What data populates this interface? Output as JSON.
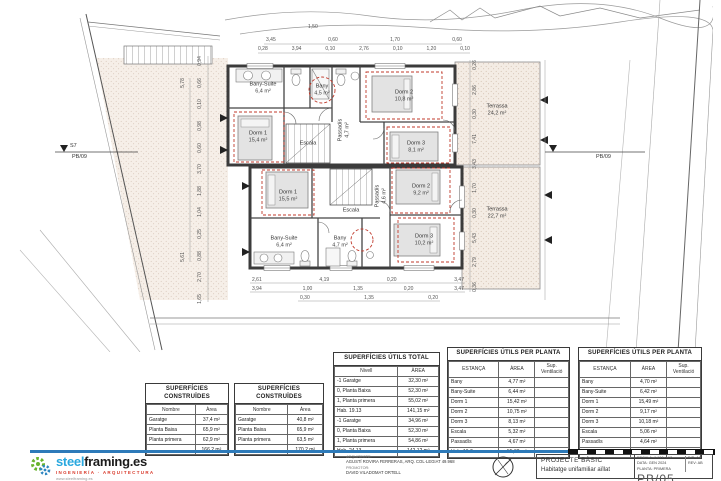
{
  "plan": {
    "upper": {
      "bany_suite": {
        "name": "Bany-Suite",
        "area": "6,4 m²"
      },
      "bany": {
        "name": "Bany",
        "area": "4,5 m²"
      },
      "dorm1": {
        "name": "Dorm 1",
        "area": "15,4 m²"
      },
      "dorm2": {
        "name": "Dorm 2",
        "area": "10,8 m²"
      },
      "dorm3": {
        "name": "Dorm 3",
        "area": "8,1 m²"
      },
      "escala": {
        "name": "Escala",
        "area": "5,3 m²"
      },
      "passadis": {
        "name": "Passadís",
        "area": "4,7 m²"
      },
      "terrassa": {
        "name": "Terrassa",
        "area": "24,2 m²"
      }
    },
    "lower": {
      "dorm1": {
        "name": "Dorm 1",
        "area": "15,5 m²"
      },
      "dorm2": {
        "name": "Dorm 2",
        "area": "9,2 m²"
      },
      "dorm3": {
        "name": "Dorm 3",
        "area": "10,2 m²"
      },
      "bany_suite": {
        "name": "Bany-Suite",
        "area": "6,4 m²"
      },
      "bany": {
        "name": "Bany",
        "area": "4,7 m²"
      },
      "escala": {
        "name": "Escala",
        "area": "5,1 m²"
      },
      "passadis": {
        "name": "Passadís",
        "area": "4,6 m²"
      },
      "terrassa": {
        "name": "Terrassa",
        "area": "22,7 m²"
      }
    },
    "markers": {
      "left_code": "S7",
      "left_sheet": "PB/09",
      "right_sheet": "PB/09"
    },
    "dims": {
      "top0": "1,50",
      "top1": [
        "3,45",
        "0,60",
        "1,70",
        "0,60"
      ],
      "top2": [
        "0,28",
        "3,94",
        "0,10",
        "2,76",
        "0,10",
        "1,20",
        "0,10"
      ],
      "bottom1": [
        "2,61",
        "4,19",
        "0,20",
        "3,47"
      ],
      "bottom2": [
        "3,94",
        "1,00",
        "1,35",
        "0,20",
        "3,47"
      ],
      "bottom3": [
        "0,30",
        "1,35",
        "0,20"
      ],
      "left_outer": [
        "5,78",
        "5,61"
      ],
      "left_inner": [
        "0,94",
        "0,66",
        "0,10",
        "0,98",
        "0,60",
        "3,70",
        "1,88",
        "1,04",
        "0,25",
        "0,88",
        "2,70",
        "1,65"
      ],
      "right_inner": [
        "0,26",
        "2,86",
        "0,30",
        "7,41",
        "3,43",
        "1,70",
        "0,30",
        "5,43",
        "2,79",
        "0,36"
      ]
    }
  },
  "tables": {
    "constructed1": {
      "title": "SUPERFÍCIES CONSTRUÏDES",
      "headers": [
        "Nombre",
        "Àrea"
      ],
      "rows": [
        [
          "Garatge",
          "37,4 m²"
        ],
        [
          "Planta Baixa",
          "65,9 m²"
        ],
        [
          "Planta primera",
          "62,9 m²"
        ],
        [
          "",
          "166,2 m²"
        ]
      ]
    },
    "constructed2": {
      "title": "SUPERFÍCIES CONSTRUÏDES",
      "headers": [
        "Nombre",
        "Àrea"
      ],
      "rows": [
        [
          "Garatge",
          "40,8 m²"
        ],
        [
          "Planta Baixa",
          "65,9 m²"
        ],
        [
          "Planta primera",
          "63,5 m²"
        ],
        [
          "",
          "170,2 m²"
        ]
      ]
    },
    "utils_total": {
      "title": "SUPERFÍCIES ÚTILS TOTAL",
      "headers": [
        "Nivell",
        "ÀREA"
      ],
      "rows": [
        [
          "-1 Garatge",
          "32,30 m²"
        ],
        [
          "0, Planta Baixa",
          "52,30 m²"
        ],
        [
          "1, Planta primera",
          "55,02 m²"
        ],
        [
          "Hab. 19.13",
          "141,15 m²"
        ],
        [
          "-1 Garatge",
          "34,96 m²"
        ],
        [
          "0, Planta Baixa",
          "52,30 m²"
        ],
        [
          "1, Planta primera",
          "54,86 m²"
        ],
        [
          "Hab. 24.13",
          "142,12 m²"
        ]
      ]
    },
    "utils_planta1": {
      "title": "SUPERFÍCIES ÚTILS PER PLANTA",
      "headers": [
        "ESTANÇA",
        "ÀREA",
        "Sup. Ventilació"
      ],
      "rows": [
        [
          "Bany",
          "4,77 m²",
          ""
        ],
        [
          "Bany-Suite",
          "6,44 m²",
          ""
        ],
        [
          "Dorm 1",
          "15,42 m²",
          ""
        ],
        [
          "Dorm 2",
          "10,75 m²",
          ""
        ],
        [
          "Dorm 3",
          "8,13 m²",
          ""
        ],
        [
          "Escala",
          "5,32 m²",
          ""
        ],
        [
          "Passadís",
          "4,67 m²",
          ""
        ],
        [
          "Hab. 19.7",
          "55,02 m²",
          ""
        ]
      ]
    },
    "utils_planta2": {
      "title": "SUPERFÍCIES ÚTILS PER PLANTA",
      "headers": [
        "ESTANÇA",
        "ÀREA",
        "Sup. Ventilació"
      ],
      "rows": [
        [
          "Bany",
          "4,70 m²",
          ""
        ],
        [
          "Bany-Suite",
          "6,42 m²",
          ""
        ],
        [
          "Dorm 1",
          "15,49 m²",
          ""
        ],
        [
          "Dorm 2",
          "9,17 m²",
          ""
        ],
        [
          "Dorm 3",
          "10,18 m²",
          ""
        ],
        [
          "Escala",
          "5,06 m²",
          ""
        ],
        [
          "Passadís",
          "4,64 m²",
          ""
        ],
        [
          "Hab. 24.7",
          "54,86 m²",
          ""
        ]
      ]
    }
  },
  "logo": {
    "word1": "steel",
    "word2": "framing",
    "word3": ".es",
    "tagline": "INGENIERÍA · ARQUITECTURA",
    "micro": "www.steelframing.es"
  },
  "titleblock": {
    "architect_label": "ARQUITECTE:",
    "architect_name": "AGUSTÍ ROVIRA FERRERAS, ARQ. COL·LEGIAT 49.968",
    "promoter_label": "PROMOTOR:",
    "promoter_name": "DAVID VILADOMAT ORTELL",
    "project_type": "PROJECTE BÀSIC",
    "project_name": "Habitatge unifamiliar aïllat",
    "scale_label": "ESCALA:",
    "scale_value": "1:100 a A3",
    "date_label": "DATA:",
    "date_value": "GEN 2024",
    "planta_label": "PLANTA:",
    "planta_value": "PRIMERA",
    "dib_label": "DIB:",
    "dib_value": "AC",
    "rev_label": "REV:",
    "rev_value": "AB",
    "sheet_code": "PB/05"
  }
}
